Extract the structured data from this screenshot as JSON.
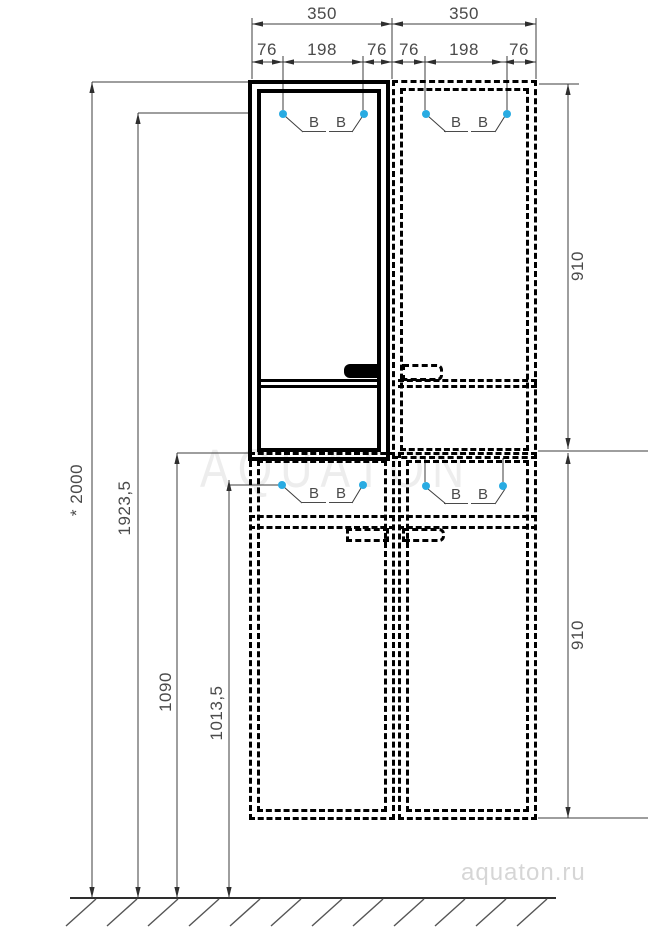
{
  "drawing": {
    "watermark_center": "AQUATON",
    "watermark_site": "aquaton.ru",
    "b_label": "B",
    "dims": {
      "widths": [
        {
          "label": "350"
        },
        {
          "label": "350"
        }
      ],
      "segments": [
        {
          "label": "76"
        },
        {
          "label": "198"
        },
        {
          "label": "76"
        },
        {
          "label": "76"
        },
        {
          "label": "198"
        },
        {
          "label": "76"
        }
      ],
      "heights_left": [
        {
          "label": "* 2000"
        },
        {
          "label": "1923,5"
        },
        {
          "label": "1090"
        },
        {
          "label": "1013,5"
        }
      ],
      "heights_right": [
        {
          "label": "910"
        },
        {
          "label": "910"
        }
      ]
    },
    "colors": {
      "line": "#000000",
      "dim_text": "#4a4a4a",
      "marker": "#29abe2",
      "watermark_center": "#ededed",
      "watermark_site": "#d6d6d6"
    }
  }
}
